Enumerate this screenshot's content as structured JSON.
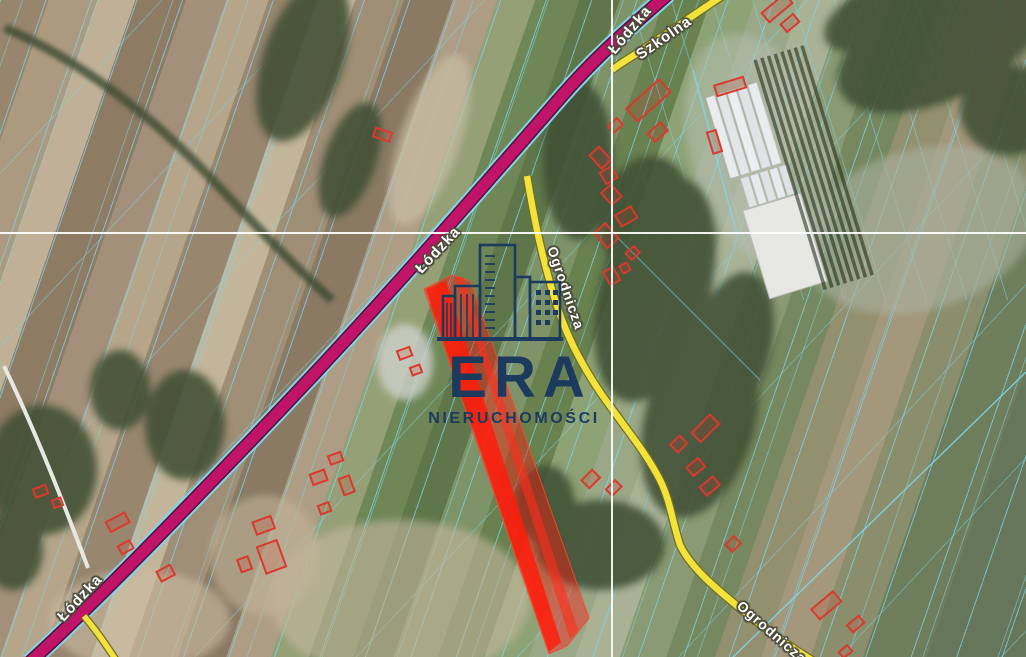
{
  "map": {
    "type": "satellite-cadastral-view",
    "selection_color": "#ff1e14",
    "parcel_line_color": "#7fd6e8",
    "crosshair_color": "#ffffff"
  },
  "roads": {
    "primary": {
      "name": "Łódzka",
      "color": "#bf1468"
    },
    "secondary": {
      "names": [
        "Szkolna",
        "Ogrodnicza"
      ],
      "color": "#f3e23c"
    },
    "labels": [
      {
        "text": "Łódzka"
      },
      {
        "text": "Łódzka"
      },
      {
        "text": "Łódzka"
      },
      {
        "text": "Szkolna"
      },
      {
        "text": "Ogrodnicza"
      },
      {
        "text": "Ogrodnicza"
      }
    ]
  },
  "watermark": {
    "brand": "ERA",
    "subtitle": "NIERUCHOMOŚCI",
    "color": "#1c3a5e"
  }
}
